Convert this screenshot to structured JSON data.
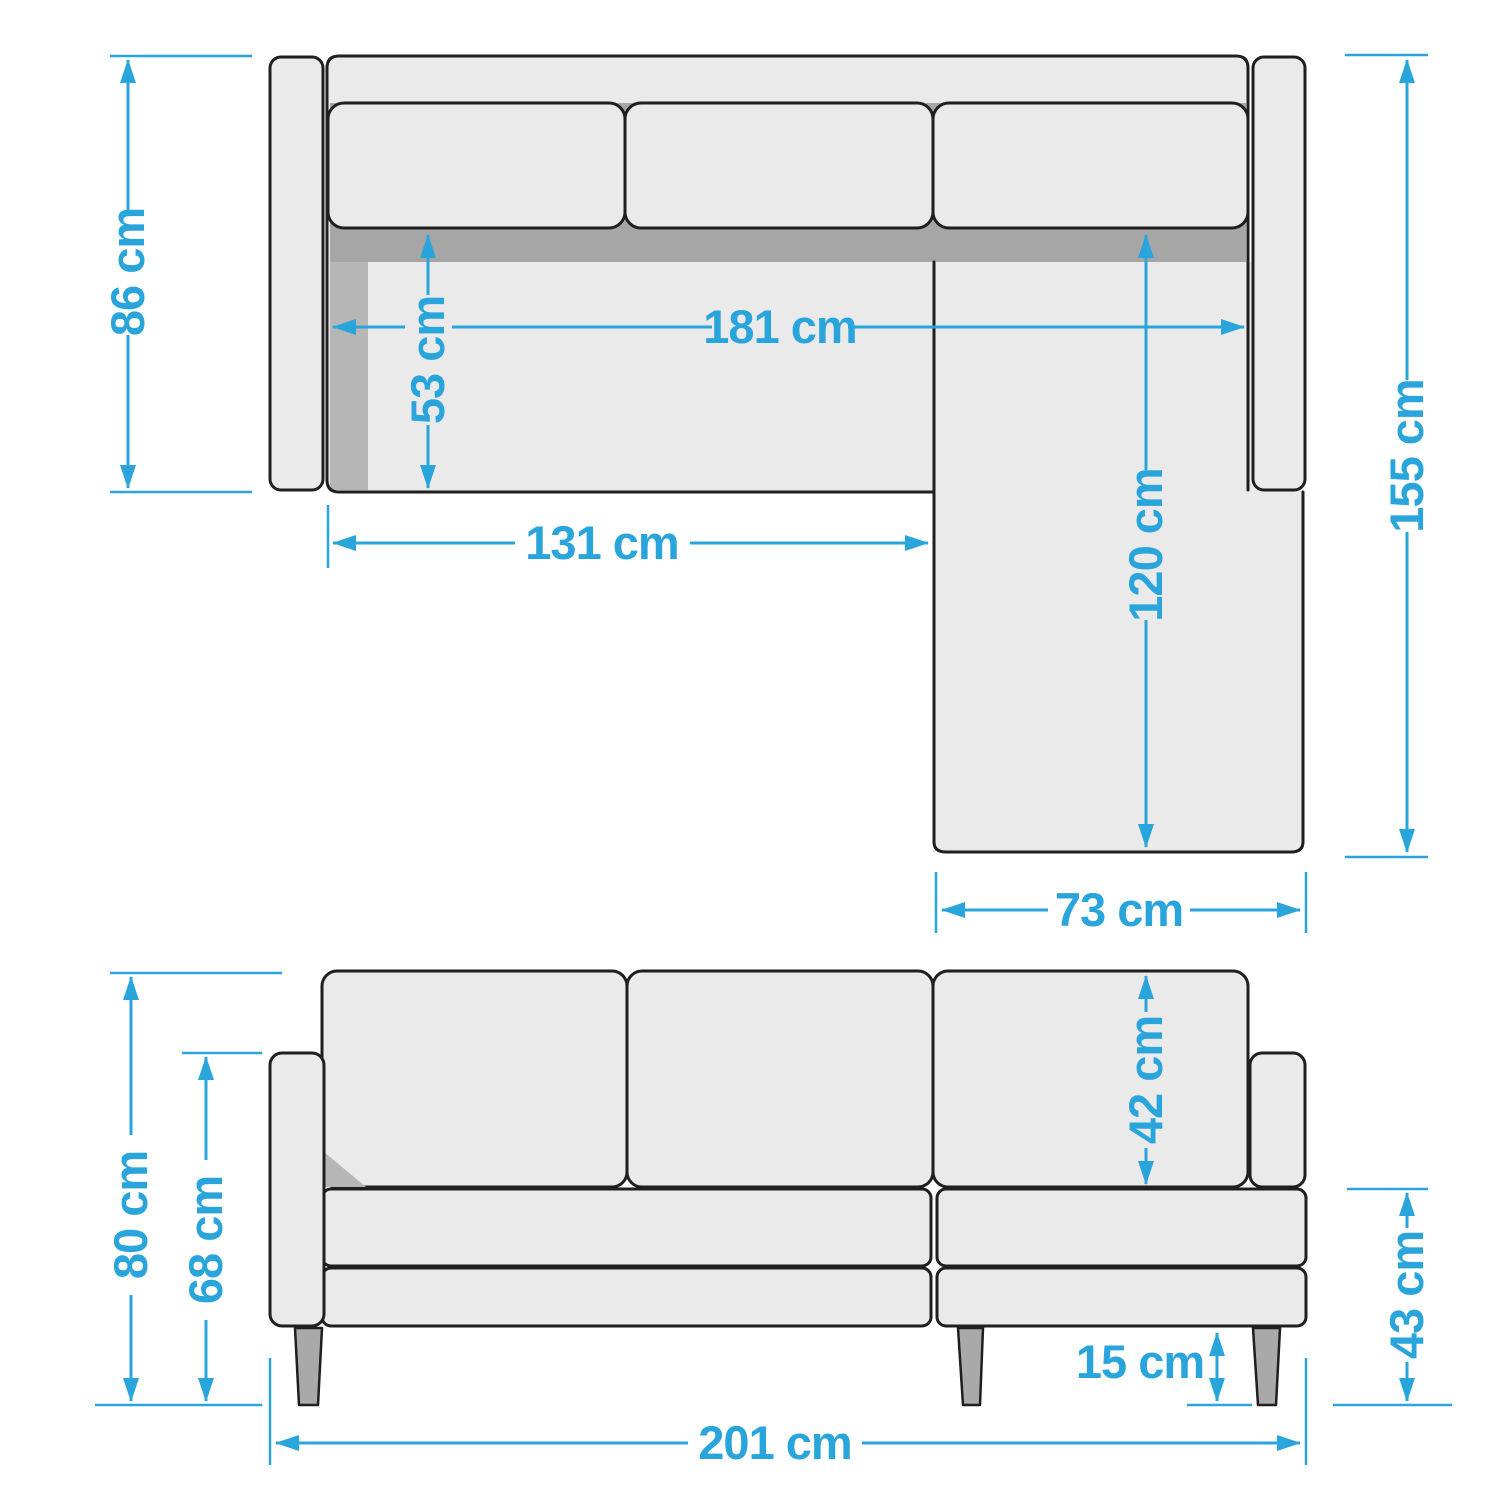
{
  "diagram": {
    "type": "furniture-dimension-diagram",
    "subject": "corner sofa with chaise, top view and front view",
    "colors": {
      "dimension_blue": "#2aa5dc",
      "outline_black": "#1f1f1f",
      "body_fill": "#eaeaea",
      "backrest_strip": "#a6a6a6",
      "shadow_gray": "#b6b6b6",
      "leg_gray": "#a9a9a9",
      "background": "#ffffff"
    },
    "top_view": {
      "dimensions": {
        "depth_main": {
          "label": "86 cm"
        },
        "inner_width": {
          "label": "181 cm"
        },
        "seat_depth": {
          "label": "53 cm"
        },
        "left_section_width": {
          "label": "131 cm"
        },
        "chaise_length": {
          "label": "120 cm"
        },
        "total_depth": {
          "label": "155 cm"
        },
        "chaise_width": {
          "label": "73 cm"
        }
      }
    },
    "front_view": {
      "dimensions": {
        "total_height": {
          "label": "80 cm"
        },
        "armrest_height": {
          "label": "68 cm"
        },
        "backrest_height": {
          "label": "42 cm"
        },
        "seat_height": {
          "label": "43 cm"
        },
        "leg_height": {
          "label": "15 cm"
        },
        "total_width": {
          "label": "201 cm"
        }
      }
    }
  }
}
